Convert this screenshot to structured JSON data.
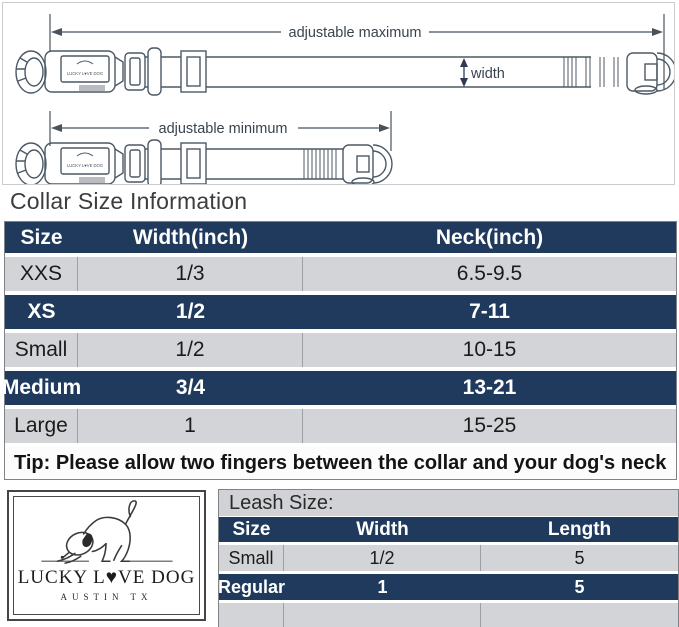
{
  "diagram": {
    "adjustable_maximum": "adjustable maximum",
    "adjustable_minimum": "adjustable minimum",
    "width_label": "width",
    "collar_tag": "LUCKY L♥VE DOG"
  },
  "collar": {
    "heading": "Collar Size Information",
    "headers": [
      "Size",
      "Width(inch)",
      "Neck(inch)"
    ],
    "rows": [
      {
        "size": "XXS",
        "width": "1/3",
        "neck": "6.5-9.5",
        "highlight": false
      },
      {
        "size": "XS",
        "width": "1/2",
        "neck": "7-11",
        "highlight": true
      },
      {
        "size": "Small",
        "width": "1/2",
        "neck": "10-15",
        "highlight": false
      },
      {
        "size": "Medium",
        "width": "3/4",
        "neck": "13-21",
        "highlight": true
      },
      {
        "size": "Large",
        "width": "1",
        "neck": "15-25",
        "highlight": false
      }
    ],
    "tip": "Tip: Please allow two fingers between the collar and your dog's neck"
  },
  "logo": {
    "brand": "LUCKY L♥VE DOG",
    "location": "AUSTIN TX"
  },
  "leash": {
    "title": "Leash Size:",
    "headers": [
      "Size",
      "Width",
      "Length"
    ],
    "rows": [
      {
        "size": "Small",
        "width": "1/2",
        "length": "5",
        "highlight": false
      },
      {
        "size": "Regular",
        "width": "1",
        "length": "5",
        "highlight": true
      }
    ]
  },
  "colors": {
    "navy": "#1f3a5c",
    "row_gray": "#d3d4d7",
    "table_border": "#7f8387",
    "diagram_stroke": "#4c5864"
  }
}
